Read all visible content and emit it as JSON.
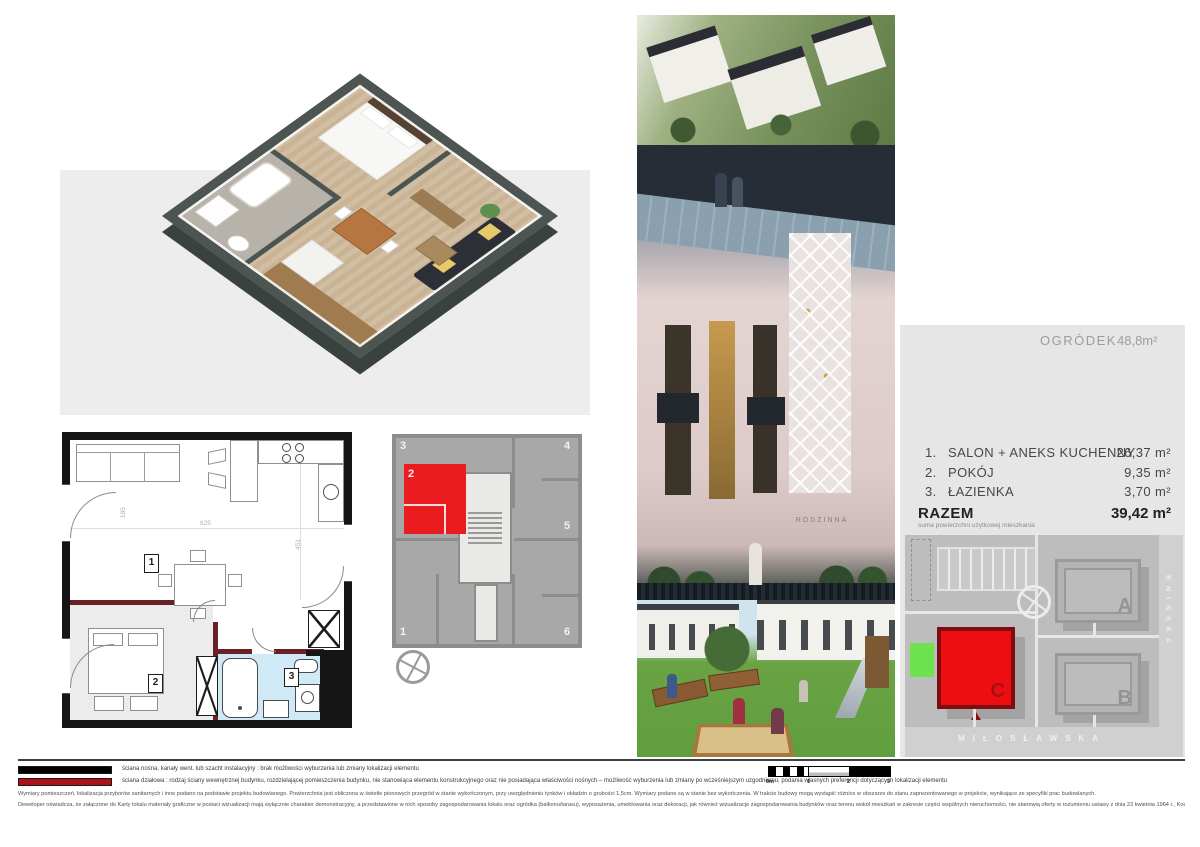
{
  "colors": {
    "accent_red": "#ea1c1f",
    "site_red": "#ec0e12",
    "site_red_border": "#7e0d10",
    "partition_wall_red": "#6a2024",
    "load_wall_black": "#151515",
    "bathroom_blue": "#cfe9f6",
    "panel_gray": "#e6e6e6",
    "keyplan_gray": "#a8a8a8",
    "garden_green": "#6ee24e"
  },
  "plan2d": {
    "room_labels": [
      "1",
      "2",
      "3"
    ],
    "dims": [
      "825",
      "451",
      "185",
      "355",
      "287"
    ]
  },
  "keyplan": {
    "units": [
      "1",
      "2",
      "3",
      "4",
      "5",
      "6"
    ],
    "highlighted_unit": "2"
  },
  "photos": {
    "facade_brand": "RODZINNA"
  },
  "panel": {
    "garden_label": "OGRÓDEK",
    "garden_area": "48,8m²",
    "rooms": [
      {
        "no": "1.",
        "name": "SALON + ANEKS KUCHENNY",
        "area": "26,37 m²"
      },
      {
        "no": "2.",
        "name": "POKÓJ",
        "area": "9,35 m²"
      },
      {
        "no": "3.",
        "name": "ŁAZIENKA",
        "area": "3,70 m²"
      }
    ],
    "total_label": "RAZEM",
    "total_note": "suma powierzchni użytkowej mieszkania",
    "total_area": "39,42 m²",
    "siteplan": {
      "buildings": [
        "A",
        "B",
        "C"
      ],
      "highlighted_building": "C",
      "street_bottom": "MIŁOSŁAWSKA",
      "street_right": "BNIŃSKA"
    }
  },
  "footer": {
    "legend": [
      {
        "color": "#000000",
        "text": "ściana nośna, kanały went. lub szacht instalacyjny : brak możliwości wyburzenia lub zmiany lokalizacji elementu"
      },
      {
        "color": "#ae1117",
        "text": "ściana działowa : rodzaj ściany wewnętrznej budynku, rozdzielającej pomieszczenia budynku, nie stanowiąca elementu konstrukcyjnego oraz nie posiadająca właściwości nośnych – możliwość wyburzenia lub zmiany po wcześniejszym uzgodnieniu, podania własnych preferencji dotyczących lokalizacji elementu"
      }
    ],
    "paragraphs": [
      "Wymiary pomieszczeń, lokalizacja przyborów sanitarnych i inne podano na podstawie projektu budowlanego. Powierzchnia jest obliczona w świetle pionowych przegród w stanie wykończonym, przy uwzględnieniu tynków i okładzin o grubości 1,5cm. Wymiary podane są w stanie bez wykończenia. W trakcie budowy mogą wystąpić różnice w obszarze do stanu zaprezentowanego w projekcie, wynikające ze specyfiki prac budowlanych.",
      "Deweloper oświadcza, że załączone do Karty lokalu materiały graficzne w postaci wizualizacji mają wyłącznie charakter demonstracyjny, a przedstawione w nich sposoby zagospodarowania lokalu oraz ogródka (balkonu/tarasu), wyposażenia, umeblowania oraz dekoracji, jak również wizualizacje zagospodarowania budynków oraz terenu wokół mieszkań w zakresie części wspólnych nieruchomości, nie stanowią oferty w rozumieniu ustawy z dnia 23 kwietnia 1964 r., Kodeks cywilny (t.j. Dz.U. z 2019 r. poz. 1145)."
    ],
    "scalebar": {
      "labels": [
        "0m",
        "1",
        "2",
        "3"
      ]
    }
  }
}
